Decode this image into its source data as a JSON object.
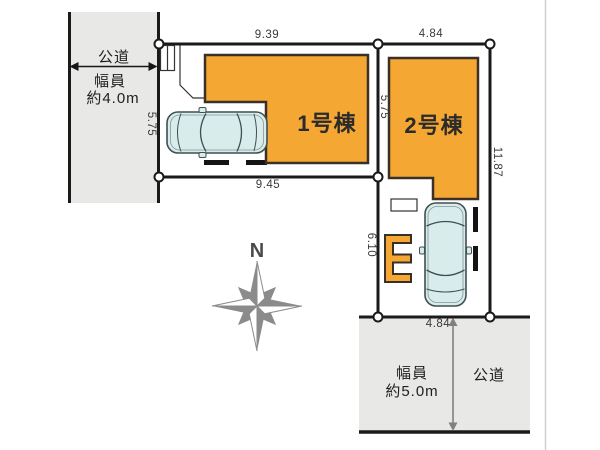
{
  "plan": {
    "compass": {
      "north_label": "N"
    },
    "roads": {
      "left": {
        "name": "公道",
        "width_line1": "幅員",
        "width_line2": "約4.0m"
      },
      "bottom": {
        "name": "公道",
        "width_line1": "幅員",
        "width_line2": "約5.0m"
      }
    },
    "lots": {
      "lot1": {
        "label": "1号棟",
        "dim_top": "9.39",
        "dim_left": "5.75",
        "dim_bottom": "9.45"
      },
      "lot2": {
        "label": "2号棟",
        "dim_top": "4.84",
        "dim_left_upper": "5.75",
        "dim_left_lower": "6.10",
        "dim_right": "11.87",
        "dim_bottom": "4.84"
      }
    },
    "colors": {
      "building_fill": "#f4a733",
      "building_border": "#3a3027",
      "road_fill": "#e8e8e6",
      "boundary_line": "#1a1a1a",
      "car_fill": "#d8eceb",
      "compass_gray": "#8b8b8b"
    }
  }
}
